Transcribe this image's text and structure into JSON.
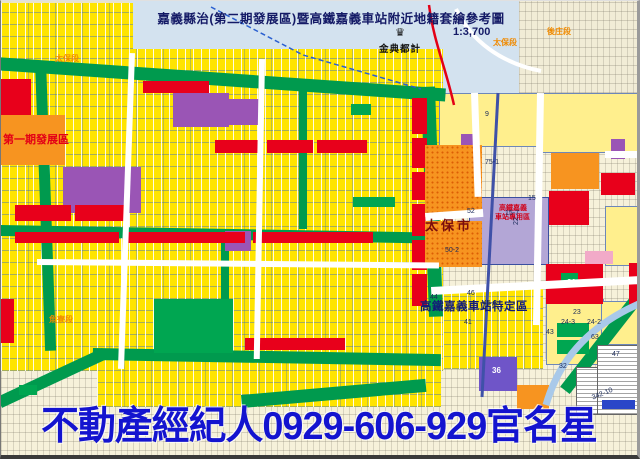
{
  "header": {
    "title": "嘉義縣治(第二期發展區)暨高鐵嘉義車站附近地籍套繪參考圖",
    "scale": "1:3,700",
    "logo_text": "金典都計",
    "logo_icon": "crown-icon",
    "logo_icon_glyph": "♛"
  },
  "ad": {
    "text": "不動產經紀人0929-606-929官名星",
    "color": "#1414cf"
  },
  "palette": {
    "water": "#d3e2ef",
    "cream": "#f1ecd6",
    "cream2": "#f6f1da",
    "devYellow": "#ffe400",
    "paleYellow": "#ffef8d",
    "green": "#009a4e",
    "parkGreen": "#00a651",
    "red": "#e8001b",
    "orange": "#f79420",
    "purple": "#9a55b5",
    "lavender": "#b3a6d6",
    "violet": "#6f55c8",
    "pink": "#f2aac8",
    "white": "#ffffff",
    "legendBlue": "#2a46c8"
  },
  "map": {
    "blocks": [
      {
        "n": "water-area",
        "x": 128,
        "y": 0,
        "w": 408,
        "h": 112,
        "c": "water"
      },
      {
        "n": "cadastral-topright",
        "x": 518,
        "y": 0,
        "w": 122,
        "h": 128,
        "c": "cream",
        "cls": "tex-fine"
      },
      {
        "n": "area-right",
        "x": 430,
        "y": 92,
        "w": 210,
        "h": 332,
        "c": "cream2",
        "cls": "tex-fine"
      },
      {
        "n": "area-bottom",
        "x": 0,
        "y": 358,
        "w": 640,
        "h": 101,
        "c": "cream2",
        "cls": "tex-fine"
      },
      {
        "n": "dev-area-topleft",
        "x": 0,
        "y": 2,
        "w": 132,
        "h": 58,
        "c": "devYellow",
        "cls": "tex-parcel"
      },
      {
        "n": "dev-area-main",
        "x": 0,
        "y": 48,
        "w": 442,
        "h": 322,
        "c": "devYellow",
        "cls": "tex-parcel"
      },
      {
        "n": "dev-area-bottom",
        "x": 96,
        "y": 358,
        "w": 344,
        "h": 48,
        "c": "devYellow",
        "cls": "tex-parcel"
      },
      {
        "n": "dev-area-station",
        "x": 442,
        "y": 288,
        "w": 100,
        "h": 80,
        "c": "devYellow",
        "cls": "tex-parcel"
      },
      {
        "n": "block-9",
        "x": 438,
        "y": 92,
        "w": 100,
        "h": 52,
        "c": "paleYellow",
        "cls": "bordered"
      },
      {
        "n": "block-ne",
        "x": 540,
        "y": 92,
        "w": 98,
        "h": 58,
        "c": "paleYellow",
        "cls": "bordered"
      },
      {
        "n": "block-e",
        "x": 604,
        "y": 205,
        "w": 36,
        "h": 58,
        "c": "paleYellow",
        "cls": "bordered"
      },
      {
        "n": "block-24",
        "x": 545,
        "y": 298,
        "w": 56,
        "h": 64,
        "c": "paleYellow",
        "cls": "bordered"
      },
      {
        "n": "block-se",
        "x": 600,
        "y": 300,
        "w": 40,
        "h": 42,
        "c": "paleYellow",
        "cls": "bordered"
      },
      {
        "n": "ring-road-top",
        "x": -6,
        "y": 56,
        "w": 452,
        "h": 13,
        "c": "green",
        "rot": 4
      },
      {
        "n": "ring-road-right",
        "x": 420,
        "y": 86,
        "w": 14,
        "h": 230,
        "c": "green",
        "rot": -2
      },
      {
        "n": "ring-road-bottom",
        "x": 92,
        "y": 347,
        "w": 348,
        "h": 12,
        "c": "green",
        "rot": 1
      },
      {
        "n": "ring-road-sw",
        "x": -4,
        "y": 396,
        "w": 116,
        "h": 12,
        "c": "green",
        "rot": -25
      },
      {
        "n": "ring-road-left",
        "x": 34,
        "y": 60,
        "w": 11,
        "h": 290,
        "c": "green",
        "rot": -2
      },
      {
        "n": "mid-road",
        "x": 0,
        "y": 224,
        "w": 434,
        "h": 11,
        "c": "green",
        "rot": 1
      },
      {
        "n": "green-street-1",
        "x": 298,
        "y": 90,
        "w": 8,
        "h": 138,
        "c": "green"
      },
      {
        "n": "green-street-2",
        "x": 220,
        "y": 236,
        "w": 8,
        "h": 114,
        "c": "green"
      },
      {
        "n": "green-curve-se",
        "x": 630,
        "y": 295,
        "w": 12,
        "h": 115,
        "c": "green",
        "rot": 38
      },
      {
        "n": "green-band-bottom",
        "x": 240,
        "y": 394,
        "w": 185,
        "h": 13,
        "c": "green",
        "rot": -5
      },
      {
        "n": "park-center",
        "x": 153,
        "y": 298,
        "w": 79,
        "h": 54,
        "c": "parkGreen"
      },
      {
        "n": "park-small-1",
        "x": 350,
        "y": 103,
        "w": 20,
        "h": 11,
        "c": "parkGreen"
      },
      {
        "n": "park-small-2",
        "x": 352,
        "y": 196,
        "w": 42,
        "h": 10,
        "c": "parkGreen"
      },
      {
        "n": "park-small-3",
        "x": 560,
        "y": 272,
        "w": 17,
        "h": 9,
        "c": "parkGreen"
      },
      {
        "n": "park-small-4",
        "x": 556,
        "y": 322,
        "w": 32,
        "h": 14,
        "c": "parkGreen"
      },
      {
        "n": "park-small-5",
        "x": 556,
        "y": 339,
        "w": 32,
        "h": 14,
        "c": "parkGreen"
      },
      {
        "n": "park-small-6",
        "x": 18,
        "y": 384,
        "w": 18,
        "h": 10,
        "c": "parkGreen"
      },
      {
        "n": "purple-block-1",
        "x": 62,
        "y": 166,
        "w": 78,
        "h": 46,
        "c": "purple"
      },
      {
        "n": "purple-block-2",
        "x": 172,
        "y": 92,
        "w": 56,
        "h": 34,
        "c": "purple"
      },
      {
        "n": "purple-block-3",
        "x": 228,
        "y": 98,
        "w": 32,
        "h": 26,
        "c": "purple"
      },
      {
        "n": "purple-block-4",
        "x": 224,
        "y": 230,
        "w": 26,
        "h": 20,
        "c": "purple"
      },
      {
        "n": "purple-block-5",
        "x": 460,
        "y": 133,
        "w": 13,
        "h": 18,
        "c": "purple"
      },
      {
        "n": "purple-block-6",
        "x": 610,
        "y": 138,
        "w": 14,
        "h": 20,
        "c": "purple"
      },
      {
        "n": "violet-block-36",
        "x": 478,
        "y": 356,
        "w": 38,
        "h": 34,
        "c": "violet"
      },
      {
        "n": "hsr-station-block",
        "x": 468,
        "y": 196,
        "w": 78,
        "h": 66,
        "c": "lavender",
        "bd": "1px solid #3a4fa0"
      },
      {
        "n": "red-block",
        "x": 0,
        "y": 78,
        "w": 30,
        "h": 38,
        "c": "red"
      },
      {
        "n": "red-block",
        "x": 142,
        "y": 80,
        "w": 66,
        "h": 12,
        "c": "red"
      },
      {
        "n": "red-block",
        "x": 14,
        "y": 204,
        "w": 56,
        "h": 16,
        "c": "red"
      },
      {
        "n": "red-block",
        "x": 74,
        "y": 204,
        "w": 50,
        "h": 16,
        "c": "red"
      },
      {
        "n": "red-strip",
        "x": 14,
        "y": 231,
        "w": 104,
        "h": 11,
        "c": "red"
      },
      {
        "n": "red-strip",
        "x": 126,
        "y": 231,
        "w": 118,
        "h": 11,
        "c": "red"
      },
      {
        "n": "red-strip",
        "x": 252,
        "y": 231,
        "w": 120,
        "h": 11,
        "c": "red"
      },
      {
        "n": "red-strip",
        "x": 214,
        "y": 139,
        "w": 48,
        "h": 13,
        "c": "red"
      },
      {
        "n": "red-strip",
        "x": 266,
        "y": 139,
        "w": 46,
        "h": 13,
        "c": "red"
      },
      {
        "n": "red-strip",
        "x": 316,
        "y": 139,
        "w": 50,
        "h": 13,
        "c": "red"
      },
      {
        "n": "red-col",
        "x": 411,
        "y": 97,
        "w": 15,
        "h": 36,
        "c": "red"
      },
      {
        "n": "red-col",
        "x": 411,
        "y": 137,
        "w": 15,
        "h": 30,
        "c": "red"
      },
      {
        "n": "red-col",
        "x": 411,
        "y": 171,
        "w": 15,
        "h": 28,
        "c": "red"
      },
      {
        "n": "red-col",
        "x": 411,
        "y": 203,
        "w": 15,
        "h": 32,
        "c": "red"
      },
      {
        "n": "red-col",
        "x": 411,
        "y": 239,
        "w": 15,
        "h": 30,
        "c": "red"
      },
      {
        "n": "red-col",
        "x": 411,
        "y": 273,
        "w": 15,
        "h": 32,
        "c": "red"
      },
      {
        "n": "red-strip",
        "x": 244,
        "y": 337,
        "w": 100,
        "h": 12,
        "c": "red"
      },
      {
        "n": "red-strip",
        "x": 0,
        "y": 298,
        "w": 13,
        "h": 44,
        "c": "red"
      },
      {
        "n": "red-block-e1",
        "x": 548,
        "y": 190,
        "w": 40,
        "h": 34,
        "c": "red"
      },
      {
        "n": "red-block-e2",
        "x": 600,
        "y": 172,
        "w": 34,
        "h": 22,
        "c": "red"
      },
      {
        "n": "red-block-21",
        "x": 545,
        "y": 263,
        "w": 57,
        "h": 40,
        "c": "red"
      },
      {
        "n": "red-sliver",
        "x": 628,
        "y": 262,
        "w": 12,
        "h": 44,
        "c": "red"
      },
      {
        "n": "park-in-21",
        "x": 560,
        "y": 272,
        "w": 17,
        "h": 9,
        "c": "parkGreen"
      },
      {
        "n": "phase1-orange",
        "x": 0,
        "y": 114,
        "w": 64,
        "h": 50,
        "c": "orange"
      },
      {
        "n": "taibao-orange-upper",
        "x": 424,
        "y": 144,
        "w": 57,
        "h": 72,
        "c": "orange",
        "cls": "tex-dots"
      },
      {
        "n": "taibao-orange-lower",
        "x": 424,
        "y": 220,
        "w": 57,
        "h": 46,
        "c": "orange",
        "cls": "tex-dots"
      },
      {
        "n": "orange-block-e",
        "x": 550,
        "y": 152,
        "w": 48,
        "h": 36,
        "c": "orange"
      },
      {
        "n": "orange-block-s",
        "x": 516,
        "y": 384,
        "w": 32,
        "h": 24,
        "c": "orange"
      },
      {
        "n": "pink-block",
        "x": 584,
        "y": 250,
        "w": 28,
        "h": 13,
        "c": "pink"
      },
      {
        "n": "white-road",
        "x": 128,
        "y": 52,
        "w": 6,
        "h": 316,
        "c": "white",
        "rot": 2
      },
      {
        "n": "white-road",
        "x": 258,
        "y": 58,
        "w": 6,
        "h": 300,
        "c": "white",
        "rot": 1
      },
      {
        "n": "white-road",
        "x": 36,
        "y": 258,
        "w": 402,
        "h": 6,
        "c": "white",
        "rot": 0.5
      },
      {
        "n": "white-road",
        "x": 424,
        "y": 212,
        "w": 58,
        "h": 8,
        "c": "white",
        "rot": -4
      },
      {
        "n": "white-road",
        "x": 430,
        "y": 286,
        "w": 210,
        "h": 8,
        "c": "white",
        "rot": -3
      },
      {
        "n": "white-road",
        "x": 536,
        "y": 92,
        "w": 7,
        "h": 232,
        "c": "white",
        "rot": 1
      },
      {
        "n": "white-road",
        "x": 470,
        "y": 92,
        "w": 7,
        "h": 104,
        "c": "white",
        "rot": -2
      },
      {
        "n": "white-road",
        "x": 604,
        "y": 150,
        "w": 36,
        "h": 7,
        "c": "white"
      },
      {
        "n": "legend-table-left",
        "x": 575,
        "y": 366,
        "w": 64,
        "h": 46,
        "c": "white",
        "cls": "legend"
      },
      {
        "n": "legend-table-right",
        "x": 596,
        "y": 344,
        "w": 43,
        "h": 68,
        "c": "white",
        "cls": "legend"
      },
      {
        "n": "legend-blue-banner",
        "x": 601,
        "y": 399,
        "w": 33,
        "h": 9,
        "c": "legendBlue"
      }
    ],
    "paths": [
      {
        "n": "provincial-highway-red",
        "d": "M428,4 C433,42 444,64 453,104",
        "stroke": "#e30016",
        "w": 2.5
      },
      {
        "n": "boundary-dashed-blue",
        "d": "M210,6 L302,54 L420,88",
        "stroke": "#2a5fd0",
        "w": 1.5,
        "dash": "5,3"
      },
      {
        "n": "hsr-rail-line",
        "d": "M497,92 L481,396",
        "stroke": "#3f51a8",
        "w": 3
      },
      {
        "n": "curved-road-se",
        "d": "M545,404 Q565,334 640,302",
        "stroke": "#a9c9e9",
        "w": 7
      },
      {
        "n": "water-road-white",
        "d": "M455,8 C470,40 500,62 540,70",
        "stroke": "#ffffff",
        "w": 4
      }
    ],
    "labels": [
      {
        "t": "太保段",
        "x": 492,
        "y": 38,
        "s": 8,
        "c": "#f08a00",
        "w": "bold"
      },
      {
        "t": "後庄段",
        "x": 546,
        "y": 27,
        "s": 8,
        "c": "#f08a00",
        "w": "bold"
      },
      {
        "t": "太保段",
        "x": 54,
        "y": 54,
        "s": 8,
        "c": "#f08a00",
        "w": "bold"
      },
      {
        "t": "魚寮段",
        "x": 48,
        "y": 315,
        "s": 8,
        "c": "#f08a00",
        "w": "bold"
      },
      {
        "t": "第一期發展區",
        "x": 2,
        "y": 134,
        "s": 11,
        "c": "#e30016",
        "w": "bold"
      },
      {
        "t": "太保市",
        "x": 424,
        "y": 218,
        "s": 13,
        "c": "#7a0c0c",
        "w": "bold",
        "ls": 3
      },
      {
        "t": "高鐵嘉義車站特定區",
        "x": 419,
        "y": 301,
        "s": 11.5,
        "c": "#121c78",
        "w": "bold",
        "ls": 0.5
      },
      {
        "t": "高鐵嘉義",
        "x": 498,
        "y": 204,
        "s": 7,
        "c": "#d00018",
        "w": "bold"
      },
      {
        "t": "車站專用區",
        "x": 494,
        "y": 213,
        "s": 7,
        "c": "#d00018",
        "w": "bold"
      },
      {
        "t": "9",
        "x": 484,
        "y": 110,
        "s": 7,
        "c": "#1a2a5a"
      },
      {
        "t": "75-1",
        "x": 484,
        "y": 158,
        "s": 7,
        "c": "#1a2a5a"
      },
      {
        "t": "52",
        "x": 466,
        "y": 207,
        "s": 7,
        "c": "#1a2a5a"
      },
      {
        "t": "50-2",
        "x": 444,
        "y": 246,
        "s": 7,
        "c": "#1a2a5a"
      },
      {
        "t": "15",
        "x": 527,
        "y": 194,
        "s": 7,
        "c": "#1a2a5a"
      },
      {
        "t": "15-7",
        "x": 504,
        "y": 209,
        "s": 7,
        "c": "#1a2a5a"
      },
      {
        "t": "22",
        "x": 512,
        "y": 224,
        "s": 7,
        "c": "#1a2a5a",
        "rot": -90
      },
      {
        "t": "21",
        "x": 566,
        "y": 278,
        "s": 8,
        "c": "#ffffff",
        "w": "bold"
      },
      {
        "t": "23",
        "x": 572,
        "y": 308,
        "s": 7,
        "c": "#1a2a5a"
      },
      {
        "t": "24-3",
        "x": 560,
        "y": 318,
        "s": 7,
        "c": "#1a2a5a"
      },
      {
        "t": "24-2",
        "x": 586,
        "y": 318,
        "s": 7,
        "c": "#1a2a5a"
      },
      {
        "t": "44",
        "x": 429,
        "y": 293,
        "s": 7,
        "c": "#1a2a5a"
      },
      {
        "t": "46",
        "x": 466,
        "y": 289,
        "s": 7,
        "c": "#1a2a5a"
      },
      {
        "t": "46-3",
        "x": 482,
        "y": 299,
        "s": 7,
        "c": "#1a2a5a"
      },
      {
        "t": "41",
        "x": 463,
        "y": 318,
        "s": 7,
        "c": "#1a2a5a"
      },
      {
        "t": "43",
        "x": 545,
        "y": 328,
        "s": 7,
        "c": "#1a2a5a"
      },
      {
        "t": "63",
        "x": 590,
        "y": 333,
        "s": 7,
        "c": "#1a2a5a"
      },
      {
        "t": "47",
        "x": 611,
        "y": 350,
        "s": 7,
        "c": "#1a2a5a"
      },
      {
        "t": "32",
        "x": 558,
        "y": 362,
        "s": 7,
        "c": "#1a2a5a"
      },
      {
        "t": "36",
        "x": 491,
        "y": 366,
        "s": 8,
        "c": "#ffffff",
        "w": "bold"
      },
      {
        "t": "342-10",
        "x": 590,
        "y": 394,
        "s": 7,
        "c": "#1a2a5a",
        "rot": -22
      }
    ]
  }
}
